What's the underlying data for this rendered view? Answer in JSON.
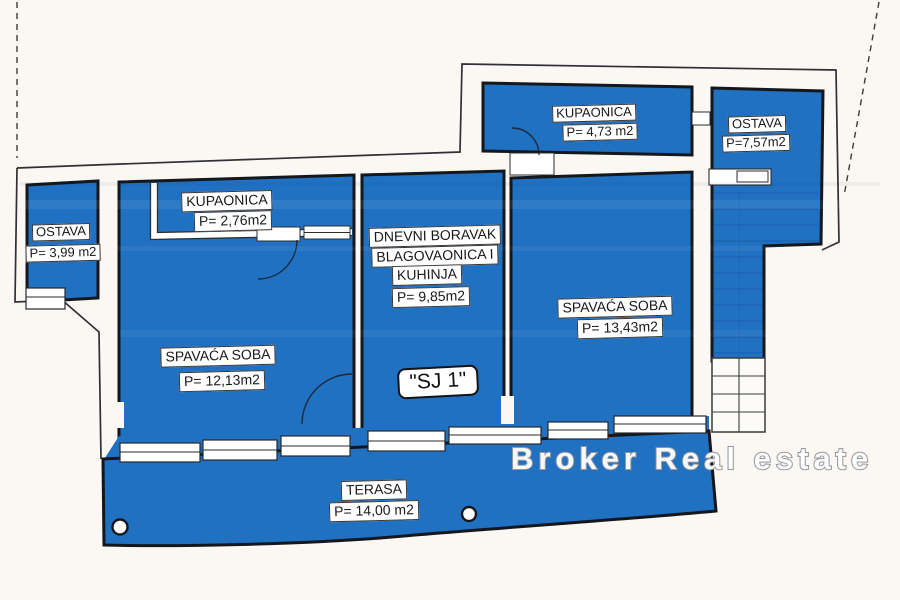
{
  "plan": {
    "watermark": "Broker Real estate",
    "unit_badge": "\"SJ 1\"",
    "rooms": [
      {
        "id": "ostava-west",
        "name": "OSTAVA",
        "area": "P= 3,99 m2"
      },
      {
        "id": "kupaonica-west",
        "name": "KUPAONICA",
        "area": "P= 2,76m2"
      },
      {
        "id": "spavaca-soba-west",
        "name": "SPAVAĆA SOBA",
        "area": "P= 12,13m2"
      },
      {
        "id": "dnevni-boravak",
        "line1": "DNEVNI BORAVAK",
        "line2": "BLAGOVAONICA I",
        "line3": "KUHINJA",
        "area": "P= 9,85m2"
      },
      {
        "id": "spavaca-soba-east",
        "name": "SPAVAĆA SOBA",
        "area": "P= 13,43m2"
      },
      {
        "id": "kupaonica-north",
        "name": "KUPAONICA",
        "area": "P= 4,73 m2"
      },
      {
        "id": "ostava-north",
        "name": "OSTAVA",
        "area": "P=7,57m2"
      },
      {
        "id": "terasa",
        "name": "TERASA",
        "area": "P= 14,00 m2"
      }
    ],
    "colors": {
      "room_fill": "#2171c2",
      "wall": "#14171b",
      "background": "#fbf7f2",
      "watermark_outline": "#97989c"
    }
  }
}
